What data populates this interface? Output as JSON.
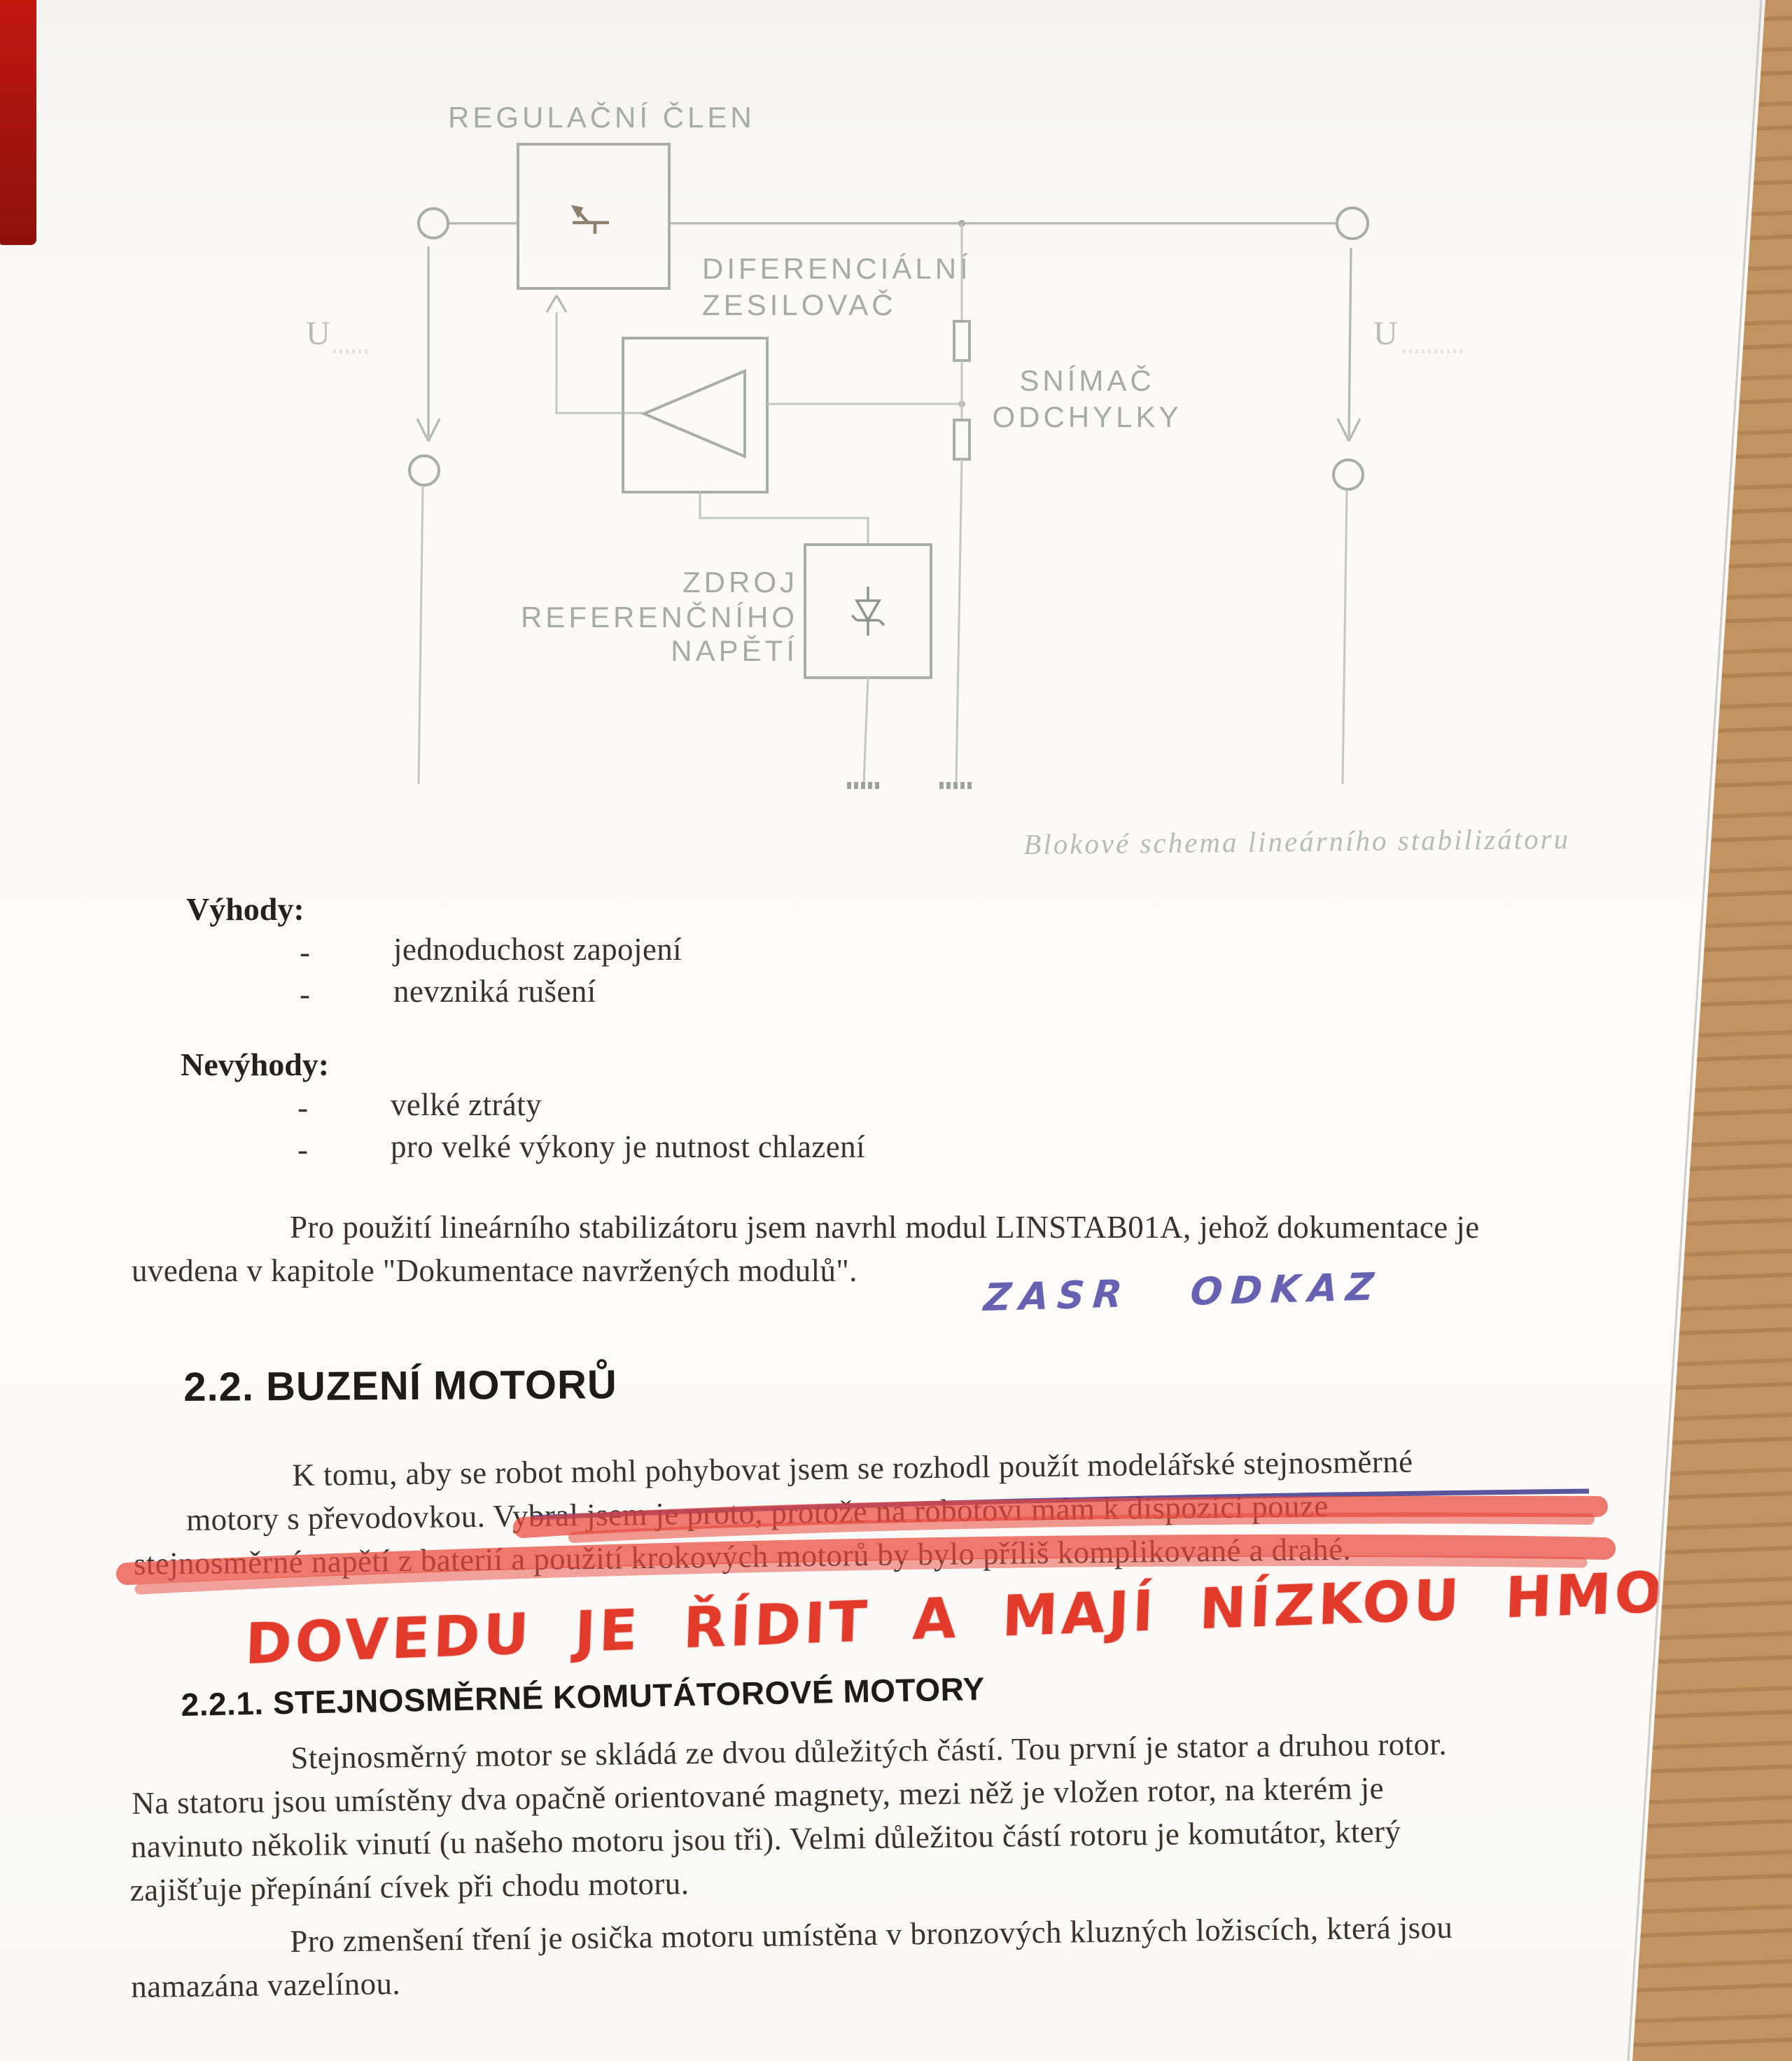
{
  "document": {
    "caption": "Blokové schema lineárního stabilizátoru",
    "list_bullet": "-"
  },
  "diagram": {
    "labels": {
      "regulator": "REGULAČNÍ ČLEN",
      "diff_amp_line1": "DIFERENCIÁLNÍ",
      "diff_amp_line2": "ZESILOVAČ",
      "sensor_line1": "SNÍMAČ",
      "sensor_line2": "ODCHYLKY",
      "reference_line1": "ZDROJ",
      "reference_line2": "REFERENČNÍHO",
      "reference_line3": "NAPĚTÍ",
      "u_input": "U",
      "u_output": "U"
    }
  },
  "advantages": {
    "heading": "Výhody:",
    "items": [
      "jednoduchost zapojení",
      "nevzniká rušení"
    ]
  },
  "disadvantages": {
    "heading": "Nevýhody:",
    "items": [
      "velké ztráty",
      "pro velké výkony je nutnost chlazení"
    ]
  },
  "para_linstab": {
    "lines": [
      "Pro použití lineárního stabilizátoru jsem navrhl modul LINSTAB01A, jehož dokumentace je",
      "uvedena v kapitole \"Dokumentace navržených modulů\"."
    ]
  },
  "annotations": {
    "blue_handwriting": "ZASR ODKAZ",
    "red_handwriting": "DOVEDU JE ŘÍDIT A MAJÍ NÍZKOU HMOTNOST",
    "pen_blue_color": "#4a44a0",
    "marker_red_color": "#e23a2b"
  },
  "section_22": {
    "heading": "2.2. BUZENÍ MOTORŮ",
    "para": {
      "line1": "K tomu, aby se robot mohl pohybovat jsem se rozhodl použít modelářské stejnosměrné",
      "line2_normal": "motory s převodovkou. ",
      "line2_struck": "Vybral jsem je proto, protože na robotovi mám k dispozici pouze",
      "line3_struck": "stejnosměrné napětí z baterií a použití krokových motorů by bylo příliš komplikované a drahé."
    }
  },
  "section_221": {
    "heading": "2.2.1. STEJNOSMĚRNÉ KOMUTÁTOROVÉ MOTORY",
    "para1": {
      "lines": [
        "Stejnosměrný motor se skládá ze dvou důležitých částí. Tou první je stator a druhou rotor.",
        "Na statoru jsou umístěny dva opačně orientované magnety, mezi něž je vložen rotor, na kterém je",
        "navinuto několik vinutí (u našeho motoru jsou tři). Velmi důležitou částí rotoru je komutátor, který",
        "zajišťuje přepínání cívek při chodu motoru."
      ]
    },
    "para2": {
      "lines": [
        "Pro zmenšení tření je osička motoru umístěna v bronzových kluzných ložiscích, která jsou",
        "namazána vazelínou."
      ]
    }
  }
}
